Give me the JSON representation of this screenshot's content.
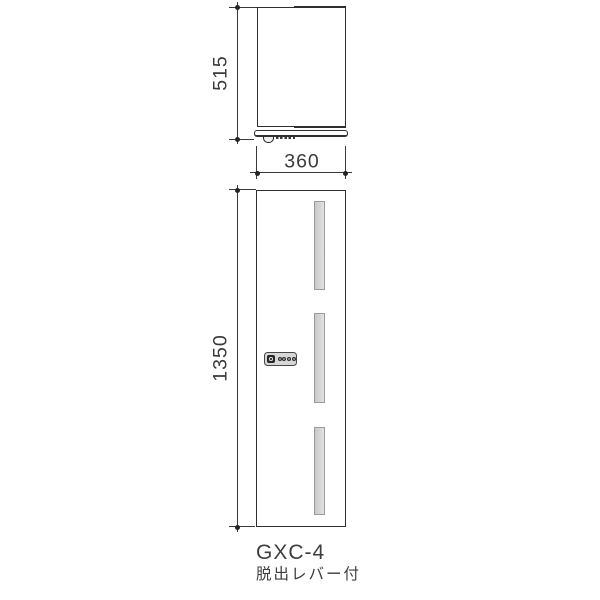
{
  "diagram": {
    "model_label": "GXC-4",
    "feature_label": "脱出レバー付",
    "dimensions": {
      "depth_mm": "515",
      "width_mm": "360",
      "height_mm": "1350"
    },
    "front_view": {
      "slot_count": 3,
      "dial_count": 4
    }
  },
  "colors": {
    "line": "#2f2f2f",
    "dim": "#3a3a3a",
    "text": "#3d3d3d",
    "slot_border": "#9b9b9b",
    "slot_fill": "#d4d4d4",
    "panel_border": "#464646",
    "panel_fill": "#d7d7d7"
  }
}
